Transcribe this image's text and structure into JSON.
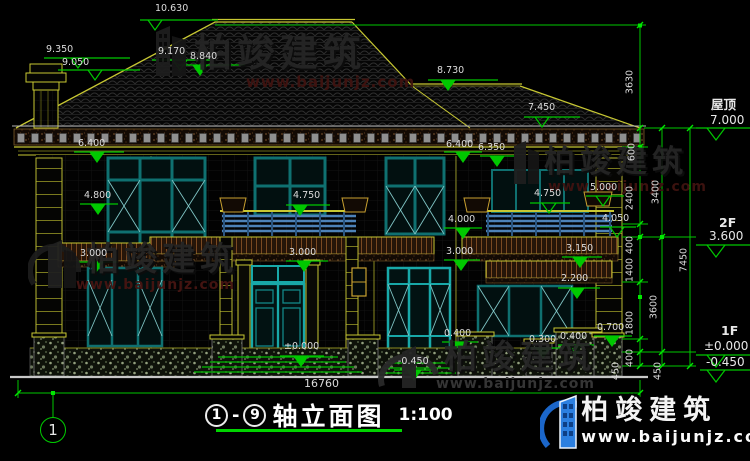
{
  "drawing": {
    "total_width_dim": "16760",
    "axis_bubble": "1",
    "title": {
      "axis_start": "1",
      "dash": "-",
      "axis_end": "9",
      "text": "轴立面图",
      "scale": "1:100"
    }
  },
  "elevations": {
    "apex": "10.630",
    "chimney_a": "9.350",
    "chimney_b": "9.050",
    "roof_left": "9.170",
    "ridge2": "8.840",
    "roof_right": "8.730",
    "roof_mid": "7.450",
    "eave_left": "6.400",
    "eave_c1": "6.400",
    "eave_c2": "6.350",
    "win2f_left": "4.800",
    "balcony_c": "4.750",
    "balcony_r": "4.750",
    "planter_r": "5.000",
    "rail_c": "4.000",
    "rail_r": "4.050",
    "sill_left": "3.000",
    "sill_c": "3.000",
    "sill_r": "3.000",
    "band_r": "3.150",
    "band_r2": "2.200",
    "plinth_a": "0.400",
    "plinth_b": "0.300",
    "plinth_c": "0.400",
    "plinth_d": "0.700",
    "floor_c": "±0.000",
    "ground_c": "-0.450"
  },
  "levels": {
    "roof_label": "屋顶",
    "roof": "7.000",
    "f2_label": "2F",
    "f2": "3.600",
    "f1_label": "1F",
    "f1": "±0.000",
    "ground": "-0.450"
  },
  "vdims": {
    "v3630": "3630",
    "v600": "600",
    "v2400": "2400",
    "v3400": "3400",
    "v400a": "400",
    "v1400": "1400",
    "v7450": "7450",
    "v3600": "3600",
    "v1800": "1800",
    "v400b": "400",
    "v450a": "450",
    "v450b": "450"
  },
  "watermark": {
    "brand": "柏竣建筑",
    "url": "www.baijunjz.com"
  },
  "colors": {
    "dim_green": "#00C800",
    "cad_yellow": "#C8C832",
    "window_teal": "#128888",
    "railing_blue": "#4D82B8",
    "brand_blue": "#1B66C9",
    "background": "#000000"
  }
}
